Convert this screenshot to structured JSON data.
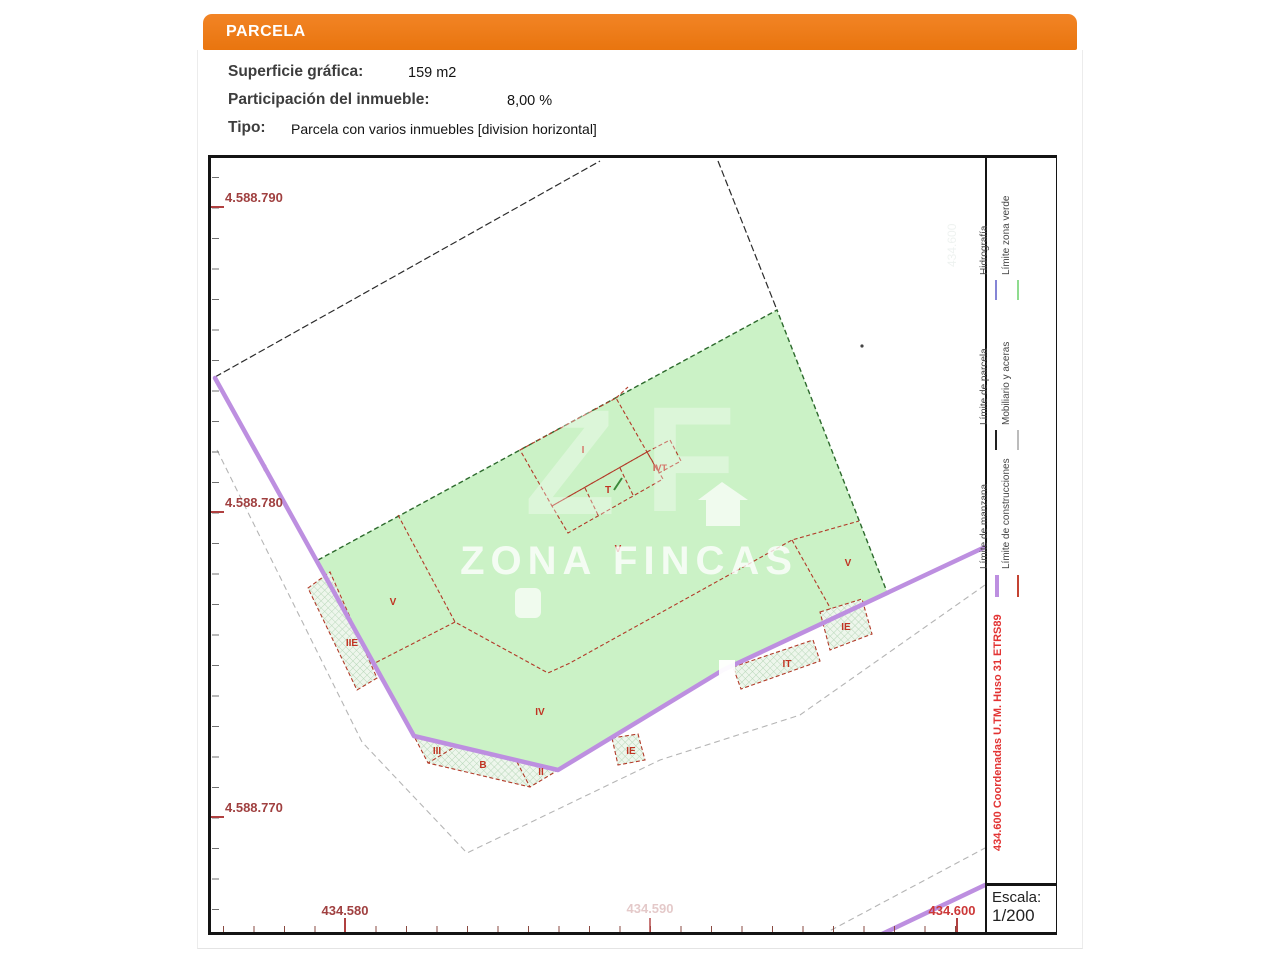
{
  "header": {
    "title": "PARCELA"
  },
  "details": [
    {
      "label": "Superficie gráfica:",
      "value": "159 m2"
    },
    {
      "label": "Participación del inmueble:",
      "value": "8,00 %"
    },
    {
      "label": "Tipo:",
      "value": "Parcela con varios inmuebles [division horizontal]"
    }
  ],
  "map": {
    "y_axis": [
      {
        "text": "4.588.790"
      },
      {
        "text": "4.588.780"
      },
      {
        "text": "4.588.770"
      }
    ],
    "x_axis": [
      {
        "text": "434.580"
      },
      {
        "text": "434.590"
      },
      {
        "text": "434.600"
      }
    ],
    "plot_labels": [
      {
        "text": "I"
      },
      {
        "text": "IVT"
      },
      {
        "text": "T"
      },
      {
        "text": "V"
      },
      {
        "text": "V"
      },
      {
        "text": "V"
      },
      {
        "text": "IV"
      },
      {
        "text": "IIE"
      },
      {
        "text": "III"
      },
      {
        "text": "B"
      },
      {
        "text": "II"
      },
      {
        "text": "IE"
      },
      {
        "text": "IT"
      },
      {
        "text": "IE"
      }
    ],
    "watermark": {
      "monogram_z": "Z",
      "monogram_f": "F",
      "wordmark": "ZONA FINCAS"
    },
    "colors": {
      "green_zone": "#cbf2c6",
      "manzana_purple": "#bd8fe0",
      "construction_red": "#b23a28",
      "header_orange": "#ed7a16"
    }
  },
  "legend": {
    "entries": [
      {
        "label": "Límite de manzana",
        "sample_style": "background:#bd8fe0"
      },
      {
        "label": "Límite de construcciones",
        "sample_style": "background:#c44332"
      },
      {
        "label": "Límite de parcela",
        "sample_style": "background:#222222"
      },
      {
        "label": "Mobiliario y aceras",
        "sample_style": "background:#bcbcbc"
      },
      {
        "label": "Hidrografía",
        "sample_style": "background:#8585d6"
      },
      {
        "label": "Límite zona verde",
        "sample_style": "background:#8fdc8f"
      }
    ],
    "coord_note": "434.600 Coordenadas U.TM. Huso 31 ETRS89"
  },
  "scale": {
    "label": "Escala:",
    "value": "1/200"
  }
}
